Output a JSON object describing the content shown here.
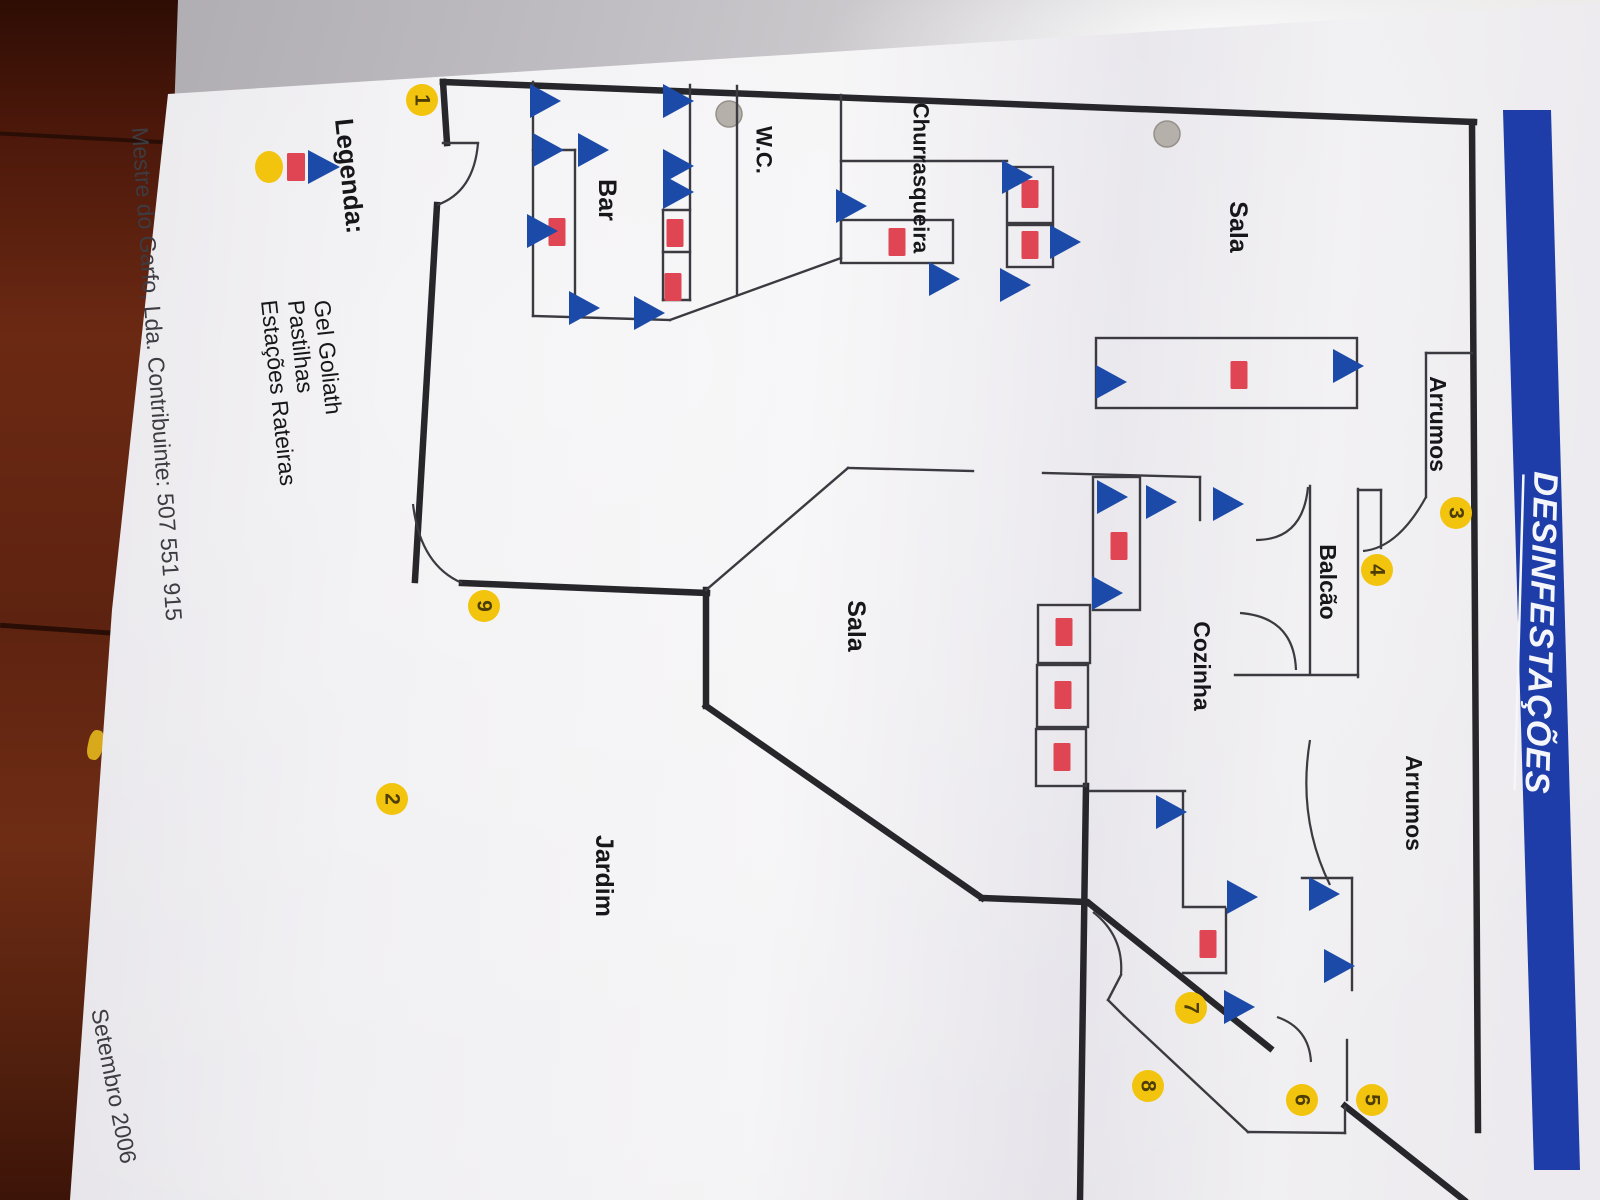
{
  "document": {
    "title": "DESINFESTAÇÕES",
    "footer": {
      "company": "Mestre do Garfo, Lda. Contribuinte: 507 551 915",
      "date": "Setembro 2006"
    },
    "legend": {
      "heading": "Legenda:",
      "items": [
        {
          "symbol": "triangle-icon",
          "label": "Gel Goliath"
        },
        {
          "symbol": "rectangle-icon",
          "label": "Pastilhas"
        },
        {
          "symbol": "ellipse-icon",
          "label": "Estações Rateiras"
        }
      ]
    },
    "colors": {
      "banner": "#1e3da8",
      "title_text": "#f5f6fb",
      "gel_triangle": "#1c4aa8",
      "pastille": "#e04553",
      "station": "#f2c40d",
      "station_digit": "#4d3e06",
      "wall": "#27272b",
      "thin_wall": "#3a3a40",
      "paper": "#efeef1",
      "label_text": "#17171b",
      "footer_text": "#3c3c42"
    }
  },
  "plan": {
    "room_labels": [
      {
        "text": "Sala",
        "x": 1238,
        "y": 227,
        "size": 25
      },
      {
        "text": "Arrumos",
        "x": 1438,
        "y": 424,
        "size": 23
      },
      {
        "text": "Balcão",
        "x": 1328,
        "y": 582,
        "size": 23
      },
      {
        "text": "Cozinha",
        "x": 1202,
        "y": 666,
        "size": 23
      },
      {
        "text": "Arrumos",
        "x": 1414,
        "y": 803,
        "size": 23
      },
      {
        "text": "Sala",
        "x": 856,
        "y": 626,
        "size": 25
      },
      {
        "text": "W.C.",
        "x": 764,
        "y": 150,
        "size": 22
      },
      {
        "text": "Churrasqueira",
        "x": 921,
        "y": 178,
        "size": 22
      },
      {
        "text": "Bar",
        "x": 607,
        "y": 200,
        "size": 25
      },
      {
        "text": "Jardim",
        "x": 604,
        "y": 876,
        "size": 25
      }
    ],
    "stations": [
      {
        "n": "1",
        "x": 422,
        "y": 100
      },
      {
        "n": "2",
        "x": 392,
        "y": 799
      },
      {
        "n": "3",
        "x": 1456,
        "y": 513
      },
      {
        "n": "4",
        "x": 1377,
        "y": 570
      },
      {
        "n": "5",
        "x": 1372,
        "y": 1100
      },
      {
        "n": "6",
        "x": 1302,
        "y": 1100
      },
      {
        "n": "7",
        "x": 1191,
        "y": 1008
      },
      {
        "n": "8",
        "x": 1148,
        "y": 1086
      },
      {
        "n": "9",
        "x": 484,
        "y": 606
      }
    ],
    "gel_points": [
      [
        542,
        101
      ],
      [
        545,
        150
      ],
      [
        590,
        150
      ],
      [
        539,
        231
      ],
      [
        581,
        308
      ],
      [
        646,
        313
      ],
      [
        675,
        101
      ],
      [
        675,
        166
      ],
      [
        675,
        192
      ],
      [
        848,
        206
      ],
      [
        941,
        279
      ],
      [
        1014,
        177
      ],
      [
        1062,
        242
      ],
      [
        1012,
        285
      ],
      [
        1108,
        382
      ],
      [
        1345,
        366
      ],
      [
        1109,
        497
      ],
      [
        1158,
        502
      ],
      [
        1225,
        504
      ],
      [
        1104,
        593
      ],
      [
        1168,
        812
      ],
      [
        1239,
        897
      ],
      [
        1236,
        1007
      ],
      [
        1321,
        894
      ],
      [
        1336,
        966
      ]
    ],
    "pastille_points": [
      [
        557,
        232
      ],
      [
        675,
        233
      ],
      [
        673,
        287
      ],
      [
        897,
        242
      ],
      [
        1030,
        194
      ],
      [
        1030,
        245
      ],
      [
        1239,
        375
      ],
      [
        1119,
        546
      ],
      [
        1064,
        632
      ],
      [
        1063,
        695
      ],
      [
        1062,
        757
      ],
      [
        1208,
        944
      ]
    ],
    "walls_thick": [
      [
        443,
        82,
        1474,
        122
      ],
      [
        443,
        82,
        447,
        143
      ],
      [
        437,
        205,
        415,
        580
      ],
      [
        462,
        583,
        707,
        593
      ],
      [
        706,
        590,
        706,
        706
      ],
      [
        706,
        706,
        982,
        898
      ],
      [
        982,
        898,
        1086,
        902
      ],
      [
        1086,
        786,
        1080,
        1200
      ],
      [
        1090,
        904,
        1270,
        1048
      ],
      [
        1345,
        1106,
        1464,
        1200
      ],
      [
        1472,
        122,
        1478,
        1130
      ]
    ],
    "walls_thin": [
      [
        533,
        82,
        533,
        316
      ],
      [
        533,
        150,
        575,
        150
      ],
      [
        575,
        150,
        575,
        316
      ],
      [
        533,
        316,
        670,
        320
      ],
      [
        690,
        85,
        690,
        300
      ],
      [
        663,
        210,
        690,
        210
      ],
      [
        663,
        210,
        663,
        300
      ],
      [
        663,
        252,
        690,
        252
      ],
      [
        663,
        300,
        690,
        300
      ],
      [
        670,
        320,
        841,
        258
      ],
      [
        737,
        86,
        737,
        295
      ],
      [
        841,
        95,
        841,
        258
      ],
      [
        841,
        161,
        1007,
        161
      ],
      [
        706,
        590,
        848,
        468
      ],
      [
        848,
        468,
        973,
        471
      ],
      [
        1043,
        473,
        1200,
        477
      ],
      [
        1200,
        477,
        1200,
        520
      ],
      [
        1310,
        486,
        1310,
        673
      ],
      [
        1358,
        489,
        1358,
        677
      ],
      [
        1235,
        675,
        1358,
        675
      ],
      [
        1358,
        490,
        1381,
        490
      ],
      [
        1381,
        490,
        1381,
        548
      ],
      [
        1426,
        353,
        1426,
        497
      ],
      [
        1426,
        353,
        1472,
        353
      ],
      [
        1090,
        791,
        1185,
        791
      ],
      [
        1183,
        792,
        1183,
        905
      ],
      [
        1183,
        907,
        1225,
        907
      ],
      [
        1226,
        909,
        1226,
        973
      ],
      [
        1183,
        973,
        1226,
        973
      ],
      [
        1302,
        878,
        1352,
        878
      ],
      [
        1352,
        878,
        1352,
        990
      ],
      [
        1347,
        1040,
        1347,
        1100
      ],
      [
        1121,
        975,
        1108,
        1000
      ],
      [
        1108,
        1000,
        1124,
        1016
      ],
      [
        1124,
        1016,
        1248,
        1132
      ],
      [
        1248,
        1132,
        1345,
        1133
      ],
      [
        1345,
        1133,
        1345,
        1107
      ],
      [
        443,
        143,
        478,
        143
      ]
    ],
    "boxes": [
      [
        1096,
        338,
        261,
        70
      ],
      [
        841,
        220,
        112,
        43
      ],
      [
        1007,
        167,
        46,
        56
      ],
      [
        1007,
        225,
        46,
        42
      ],
      [
        1093,
        477,
        47,
        133
      ],
      [
        1038,
        605,
        52,
        58
      ],
      [
        1037,
        665,
        51,
        62
      ],
      [
        1036,
        729,
        50,
        57
      ]
    ],
    "curves": [
      "M478,143 Q474,192 437,205",
      "M413,504 Q420,565 462,583",
      "M1308,487 Q1303,540 1256,540",
      "M1240,613 Q1294,617 1296,670",
      "M1426,497 Q1398,548 1363,551",
      "M1310,740 Q1297,818 1330,885",
      "M1093,912 Q1124,936 1121,975",
      "M1277,1017 Q1309,1028 1311,1062"
    ],
    "holes": [
      [
        729,
        114
      ],
      [
        1167,
        134
      ]
    ],
    "paper_outline": "M168,94 L1556,6 L1600,3 L1600,1200 L70,1200 L112,610 Z",
    "banner_points": "1503,110 1551,110 1580,1170 1534,1170",
    "title_pos": {
      "x": 1541,
      "y": 633,
      "angle": 91.6,
      "size": 34
    },
    "legend_layout": {
      "heading_pos": {
        "x": 350,
        "y": 176,
        "angle": 84,
        "size": 26
      },
      "symbol_x": [
        322,
        296,
        269
      ],
      "symbol_y": 167,
      "label_y": 300,
      "label_size": 23,
      "label_angle": 84
    },
    "footer_layout": {
      "company_pos": {
        "x": 157,
        "y": 374,
        "angle": 86,
        "size": 23
      },
      "date_pos": {
        "x": 114,
        "y": 1086,
        "angle": 79,
        "size": 23
      }
    }
  }
}
